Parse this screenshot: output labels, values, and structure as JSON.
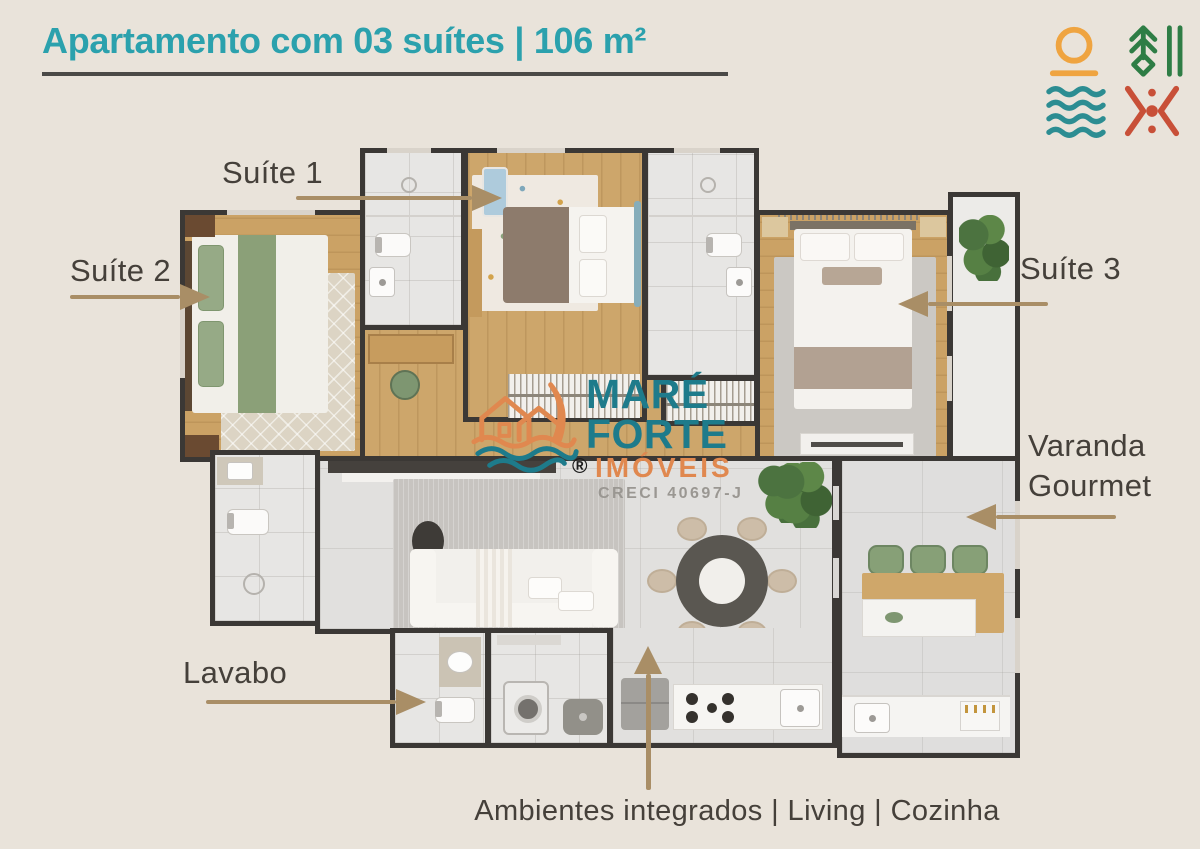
{
  "header": {
    "title": "Apartamento com 03 suítes | 106 m²"
  },
  "brand": {
    "icons": [
      {
        "name": "sun-over-horizon",
        "color": "#efa440"
      },
      {
        "name": "pine-tree-with-bars",
        "color": "#2e7d45"
      },
      {
        "name": "water-waves",
        "color": "#2c8d92"
      },
      {
        "name": "chevrons-and-dots",
        "color": "#c85038"
      }
    ]
  },
  "watermark": {
    "name_line1": "MARÉ",
    "name_line2": "FORTE",
    "name_line3": "IMÓVEIS",
    "registered_mark": "®",
    "creci": "CRECI 40697-J"
  },
  "rooms": {
    "suite1": {
      "label": "Suíte 1"
    },
    "suite2": {
      "label": "Suíte 2"
    },
    "suite3": {
      "label": "Suíte 3"
    },
    "varanda": {
      "label_line1": "Varanda",
      "label_line2": "Gourmet"
    },
    "lavabo": {
      "label": "Lavabo"
    },
    "integrated": {
      "label": "Ambientes integrados | Living | Cozinha"
    }
  },
  "palette": {
    "background": "#e9e3da",
    "title_teal": "#2ba1ad",
    "title_underline": "#4b4a47",
    "label_text": "#45403a",
    "arrow_tan": "#a98e66",
    "wall_dark": "#3b3835",
    "wood_floor": "#cda66b",
    "tile_light": "#e7e6e4",
    "watermark_teal": "#1e7b8b",
    "watermark_orange": "#e0884f"
  }
}
